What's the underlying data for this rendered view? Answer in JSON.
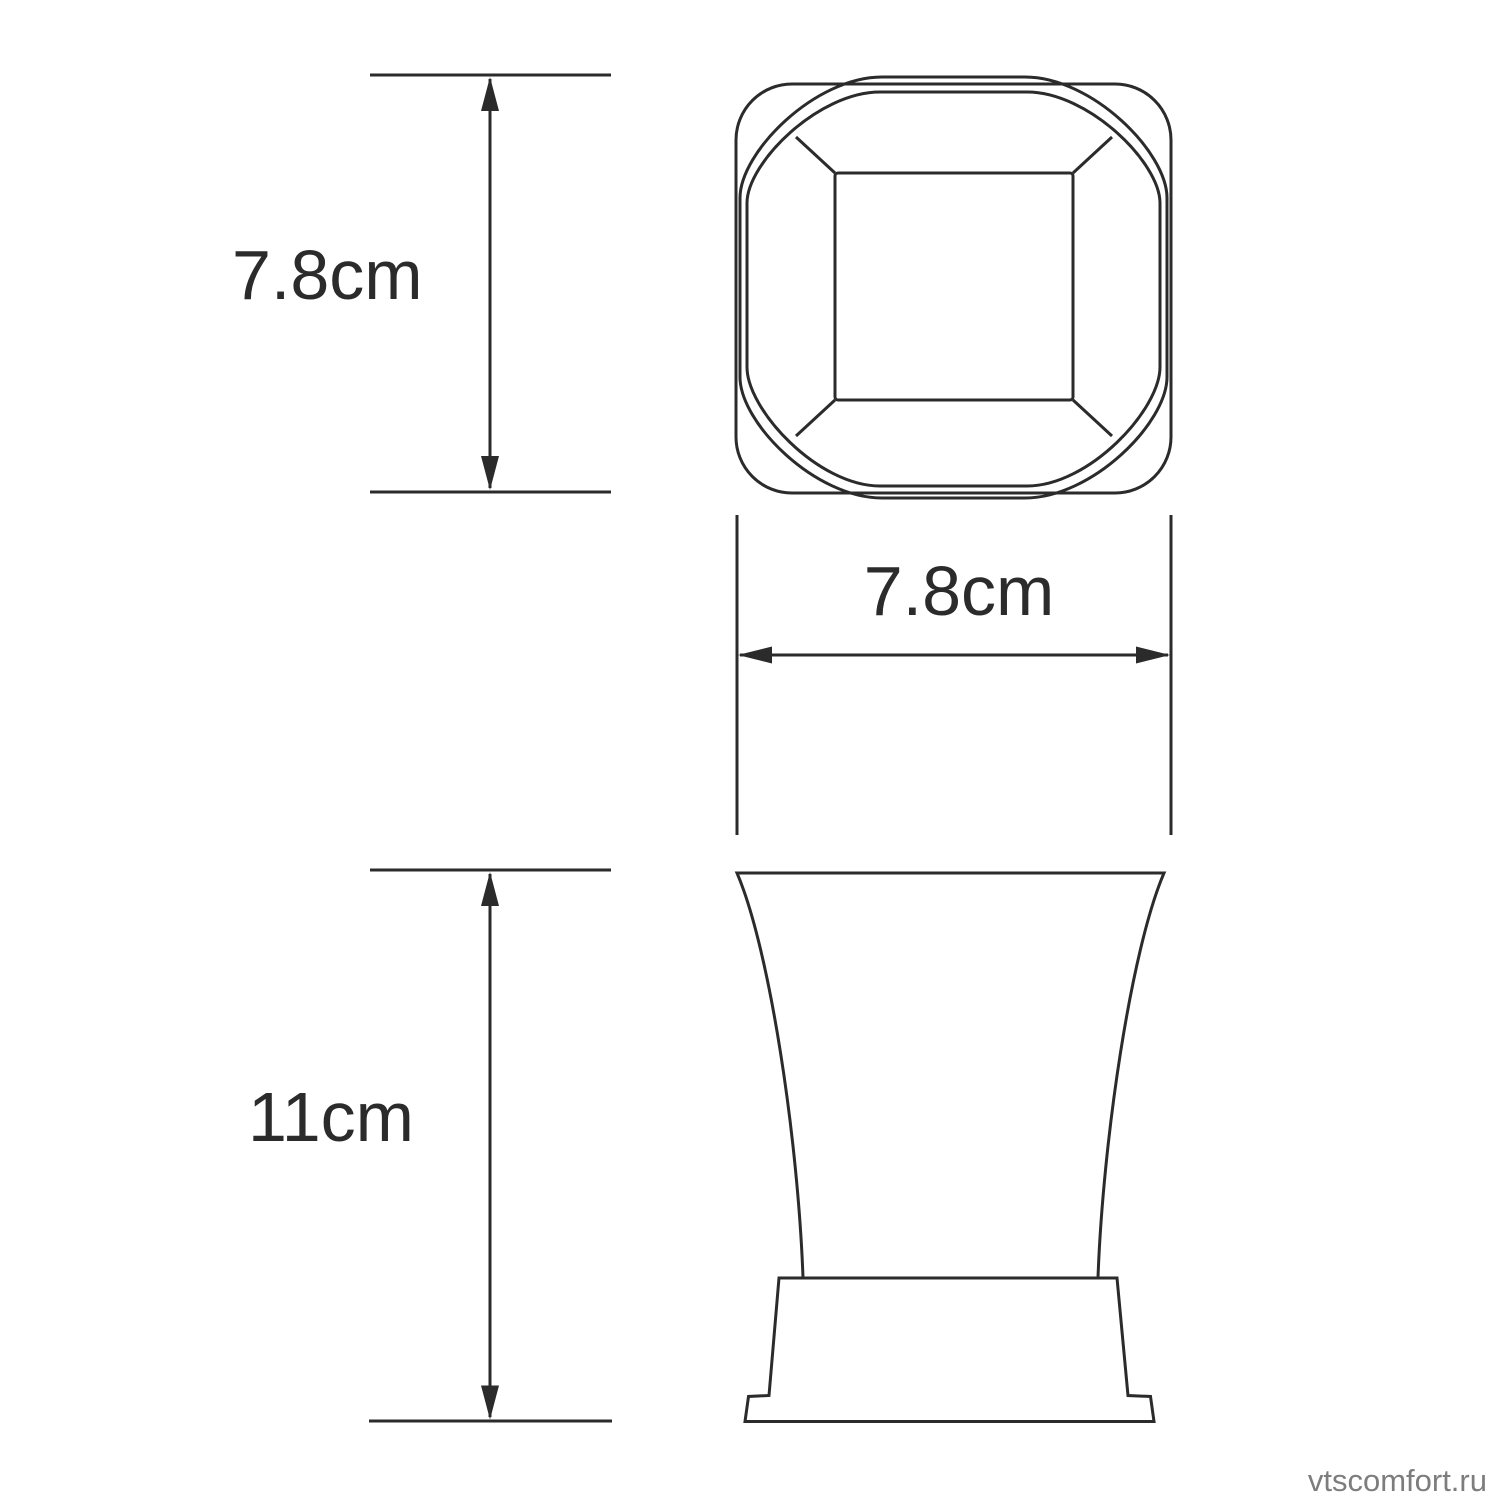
{
  "dimensions": [
    {
      "id": "top-view-height",
      "value": "7.8cm",
      "orientation": "vertical"
    },
    {
      "id": "top-view-width",
      "value": "7.8cm",
      "orientation": "horizontal"
    },
    {
      "id": "front-view-height",
      "value": "11cm",
      "orientation": "vertical"
    }
  ],
  "watermark": {
    "text": "vtscomfort.ru",
    "color": "#7d7d7d"
  },
  "colors": {
    "line": "#2b2b2b",
    "background": "#ffffff",
    "text": "#2b2b2b"
  }
}
